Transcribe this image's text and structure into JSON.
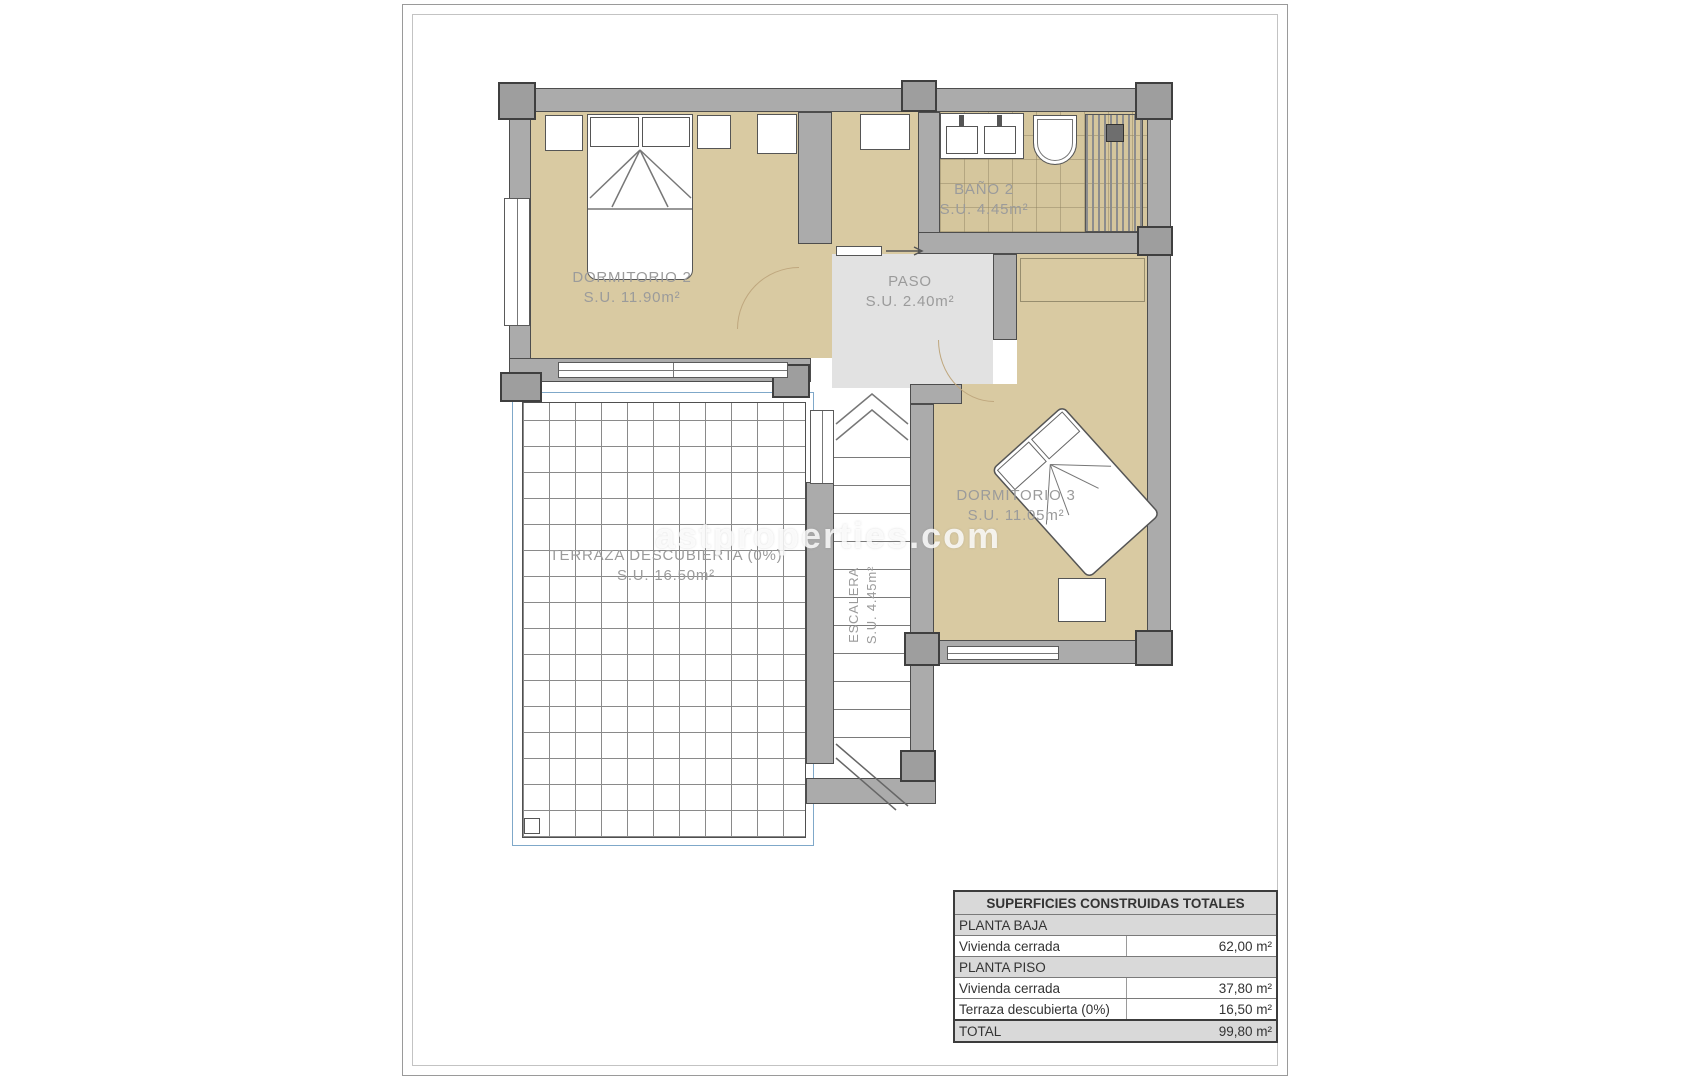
{
  "watermark": {
    "text": "astproperties.com"
  },
  "rooms": {
    "dormitorio2": {
      "name": "DORMITORIO 2",
      "area": "S.U. 11.90m²"
    },
    "bano2": {
      "name": "BAÑO 2",
      "area": "S.U. 4.45m²"
    },
    "paso": {
      "name": "PASO",
      "area": "S.U. 2.40m²"
    },
    "dormitorio3": {
      "name": "DORMITORIO 3",
      "area": "S.U. 11.05m²"
    },
    "terraza": {
      "name": "TERRAZA DESCUBIERTA (0%)",
      "area": "S.U. 16.50m²"
    },
    "escalera": {
      "name": "ESCALERA",
      "area": "S.U. 4.45m²"
    }
  },
  "summary_table": {
    "title": "SUPERFICIES CONSTRUIDAS TOTALES",
    "rows": [
      {
        "label": "PLANTA BAJA",
        "value": "",
        "type": "section"
      },
      {
        "label": "Vivienda cerrada",
        "value": "62,00 m²",
        "type": "data"
      },
      {
        "label": "PLANTA PISO",
        "value": "",
        "type": "section"
      },
      {
        "label": "Vivienda cerrada",
        "value": "37,80 m²",
        "type": "data"
      },
      {
        "label": "Terraza descubierta (0%)",
        "value": "16,50 m²",
        "type": "data"
      },
      {
        "label": "TOTAL",
        "value": "99,80 m²",
        "type": "total"
      }
    ]
  },
  "colors": {
    "wall": "#ababab",
    "floor_tan": "#d9caa2",
    "paso_gray": "#e2e2e2",
    "terraza_blue": "#7fa8c9"
  }
}
